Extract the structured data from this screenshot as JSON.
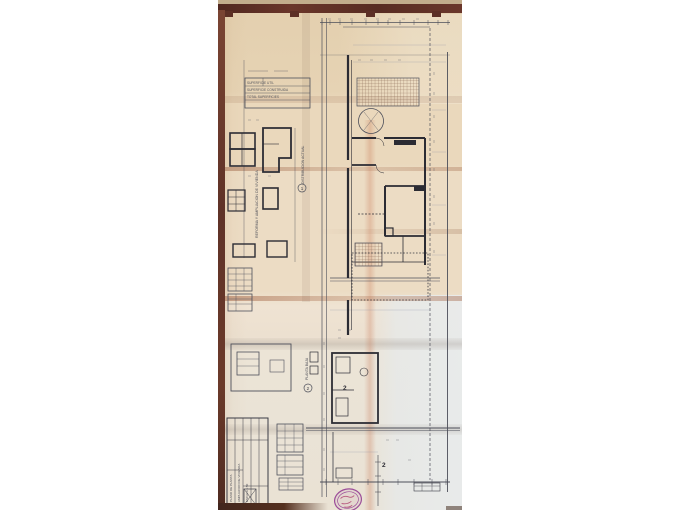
{
  "photo": {
    "description": "Folded architectural floor-plan drawing photographed lying on a dark wooden surface",
    "colors": {
      "page_background": "#ffffff",
      "paper": "#e8d5b8",
      "paper_light_panel": "#e9e6df",
      "wood_dark": "#5c2f25",
      "wood_tan": "#c2ad8c",
      "ink": "#4d4f5a",
      "ink_heavy": "#2b2b33",
      "crease": "#b5795c",
      "stamp_purple": "#9c4d99",
      "stamp_red": "#b24a74"
    },
    "annotations": {
      "legend_rows": [
        "SUPERFICIE UTIL",
        "SUPERFICIE CONSTRUIDA",
        "TOTAL SUPERFICIES"
      ],
      "left_vertical_note": "REFORMA Y AMPLIACION DE VIVIENDA",
      "mid_vertical_note": "DISTRIBUCION ACTUAL",
      "lower_vertical_note": "PLANTA BAJA",
      "circle_mark_upper": "1",
      "circle_mark_lower": "2",
      "room_number_mid": "2",
      "room_number_bottom": "2",
      "title_block_lines": [
        "PLANO DE PLANTA",
        "AMPLIACION DE VIVIENDA",
        "ESCALA 1:50"
      ]
    }
  }
}
